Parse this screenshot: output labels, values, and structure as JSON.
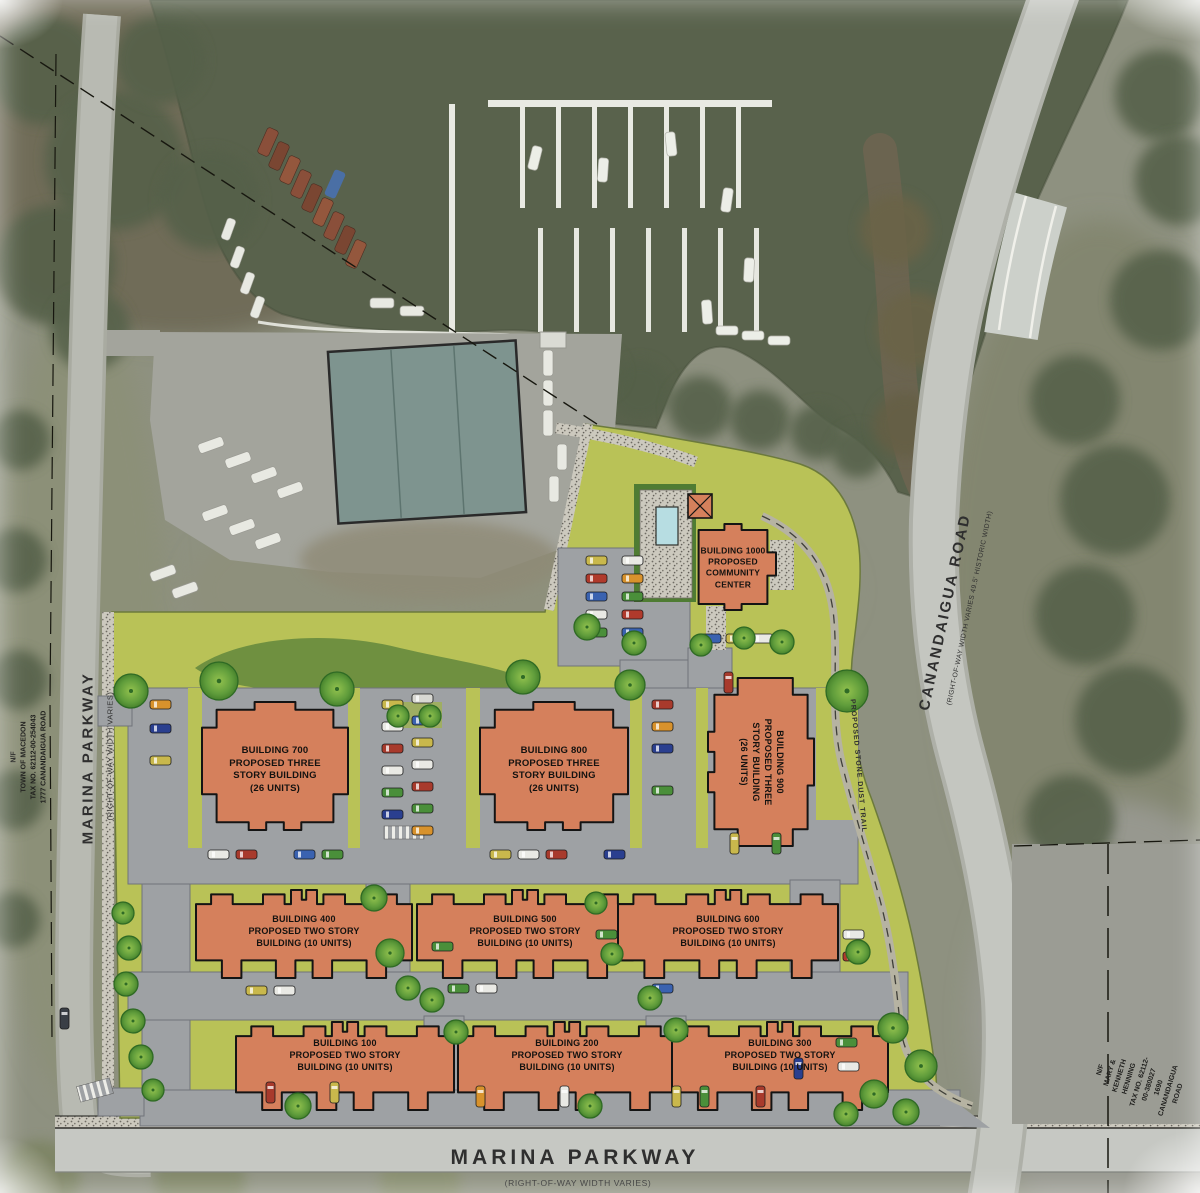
{
  "plan": {
    "roads": {
      "marina_parkway_left": {
        "name": "MARINA PARKWAY",
        "detail": "(RIGHT-OF-WAY WIDTH VARIES)"
      },
      "marina_parkway_bottom": {
        "name": "MARINA PARKWAY",
        "detail": "(RIGHT-OF-WAY WIDTH VARIES)"
      },
      "canandaigua_road": {
        "name": "CANANDAIGUA ROAD",
        "detail": "(RIGHT-OF-WAY WIDTH VARIES 49.5' HISTORIC WIDTH)"
      }
    },
    "parcel_notes": {
      "west": "N/F\nTOWN OF MACEDON\nTAX NO. 62112-00-254043\n1777 CANANDAIGUA ROAD",
      "east": "N/F\nMARY & KENNETH HENNING\nTAX NO. 62112-00-380027\n1690 CANANDAIGUA ROAD"
    },
    "trail_label": "PROPOSED STONE DUST TRAIL",
    "buildings": [
      {
        "id": "700",
        "label": "BUILDING 700\nPROPOSED THREE\nSTORY BUILDING\n(26 UNITS)",
        "shape": "h3",
        "x": 202,
        "y": 702,
        "w": 146,
        "h": 128,
        "lx": 275,
        "ly": 770,
        "fs": 9.5
      },
      {
        "id": "800",
        "label": "BUILDING 800\nPROPOSED THREE\nSTORY BUILDING\n(26 UNITS)",
        "shape": "h3",
        "x": 480,
        "y": 702,
        "w": 148,
        "h": 128,
        "lx": 554,
        "ly": 770,
        "fs": 9.5
      },
      {
        "id": "900",
        "label": "BUILDING 900\nPROPOSED THREE\nSTORY BUILDING\n(26 UNITS)",
        "shape": "h3",
        "rot": 90,
        "x": 708,
        "y": 678,
        "w": 106,
        "h": 168,
        "lx": 761,
        "ly": 762,
        "fs": 9
      },
      {
        "id": "400",
        "label": "BUILDING 400\nPROPOSED TWO STORY\nBUILDING (10 UNITS)",
        "shape": "bar",
        "x": 196,
        "y": 890,
        "w": 216,
        "h": 88,
        "lx": 304,
        "ly": 932,
        "fs": 9
      },
      {
        "id": "500",
        "label": "BUILDING 500\nPROPOSED TWO STORY\nBUILDING (10 UNITS)",
        "shape": "bar",
        "x": 417,
        "y": 890,
        "w": 216,
        "h": 88,
        "lx": 525,
        "ly": 932,
        "fs": 9
      },
      {
        "id": "600",
        "label": "BUILDING 600\nPROPOSED TWO STORY\nBUILDING (10 UNITS)",
        "shape": "bar",
        "x": 618,
        "y": 890,
        "w": 220,
        "h": 88,
        "lx": 728,
        "ly": 932,
        "fs": 9
      },
      {
        "id": "100",
        "label": "BUILDING 100\nPROPOSED TWO STORY\nBUILDING (10 UNITS)",
        "shape": "bar",
        "x": 236,
        "y": 1022,
        "w": 218,
        "h": 88,
        "lx": 345,
        "ly": 1056,
        "fs": 9
      },
      {
        "id": "200",
        "label": "BUILDING 200\nPROPOSED TWO STORY\nBUILDING (10 UNITS)",
        "shape": "bar",
        "x": 458,
        "y": 1022,
        "w": 218,
        "h": 88,
        "lx": 567,
        "ly": 1056,
        "fs": 9
      },
      {
        "id": "300",
        "label": "BUILDING 300\nPROPOSED TWO STORY\nBUILDING (10 UNITS)",
        "shape": "bar",
        "x": 672,
        "y": 1022,
        "w": 216,
        "h": 88,
        "lx": 780,
        "ly": 1056,
        "fs": 9
      },
      {
        "id": "1000",
        "label": "BUILDING 1000\nPROPOSED\nCOMMUNITY\nCENTER",
        "shape": "cc",
        "x": 690,
        "y": 524,
        "w": 86,
        "h": 86,
        "lx": 733,
        "ly": 568,
        "fs": 8.5
      }
    ],
    "colors": {
      "site_green": "#b9c257",
      "building": "#d5805c",
      "building_outline": "#141414",
      "pavement": "#9ea1a4",
      "water": "#59624c",
      "road": "#c4c6c0",
      "pool": "#b7dde2"
    }
  },
  "decor": {
    "trees": [
      [
        131,
        691,
        17
      ],
      [
        219,
        681,
        19
      ],
      [
        337,
        689,
        17
      ],
      [
        523,
        677,
        17
      ],
      [
        630,
        685,
        15
      ],
      [
        847,
        691,
        21
      ],
      [
        587,
        627,
        13
      ],
      [
        634,
        643,
        12
      ],
      [
        701,
        645,
        11
      ],
      [
        744,
        638,
        11
      ],
      [
        782,
        642,
        12
      ],
      [
        398,
        716,
        11
      ],
      [
        430,
        716,
        11
      ],
      [
        374,
        898,
        13
      ],
      [
        390,
        953,
        14
      ],
      [
        408,
        988,
        12
      ],
      [
        596,
        903,
        11
      ],
      [
        612,
        954,
        11
      ],
      [
        123,
        913,
        11
      ],
      [
        129,
        948,
        12
      ],
      [
        126,
        984,
        12
      ],
      [
        133,
        1021,
        12
      ],
      [
        141,
        1057,
        12
      ],
      [
        153,
        1090,
        11
      ],
      [
        432,
        1000,
        12
      ],
      [
        456,
        1032,
        12
      ],
      [
        650,
        998,
        12
      ],
      [
        676,
        1030,
        12
      ],
      [
        893,
        1028,
        15
      ],
      [
        921,
        1066,
        16
      ],
      [
        874,
        1094,
        14
      ],
      [
        846,
        1114,
        12
      ],
      [
        906,
        1112,
        13
      ],
      [
        858,
        952,
        12
      ],
      [
        298,
        1106,
        13
      ],
      [
        590,
        1106,
        12
      ]
    ],
    "brush": [
      [
        45,
        70,
        55
      ],
      [
        115,
        160,
        70
      ],
      [
        55,
        265,
        60
      ],
      [
        160,
        60,
        45
      ],
      [
        210,
        200,
        50
      ],
      [
        90,
        330,
        40
      ],
      [
        640,
        390,
        30
      ],
      [
        700,
        408,
        32
      ],
      [
        760,
        420,
        30
      ],
      [
        818,
        432,
        28
      ],
      [
        858,
        452,
        26
      ],
      [
        600,
        372,
        24
      ],
      [
        895,
        230,
        35,
        "#6b6347"
      ],
      [
        915,
        330,
        38,
        "#6b6347"
      ],
      [
        905,
        425,
        32,
        "#655f45"
      ],
      [
        1160,
        95,
        45
      ],
      [
        1180,
        180,
        45
      ],
      [
        1160,
        300,
        50
      ],
      [
        1075,
        400,
        45
      ],
      [
        1115,
        500,
        55
      ],
      [
        1085,
        615,
        50
      ],
      [
        1130,
        720,
        55
      ],
      [
        1070,
        820,
        45
      ],
      [
        1110,
        890,
        40
      ],
      [
        20,
        440,
        30
      ],
      [
        15,
        560,
        32
      ],
      [
        18,
        680,
        30
      ],
      [
        14,
        800,
        30
      ],
      [
        12,
        920,
        28
      ],
      [
        40,
        1180,
        40,
        "#7d8464"
      ],
      [
        200,
        1182,
        45,
        "#7d8464"
      ],
      [
        420,
        1184,
        40,
        "#868c6c"
      ]
    ],
    "cars": [
      [
        586,
        556,
        "h",
        "#c9b84c"
      ],
      [
        586,
        574,
        "h",
        "#b03a2c"
      ],
      [
        586,
        592,
        "h",
        "#3a62b0"
      ],
      [
        586,
        610,
        "h",
        "#e9e9e4"
      ],
      [
        586,
        628,
        "h",
        "#4a8f3a"
      ],
      [
        622,
        556,
        "h",
        "#e9e9e4"
      ],
      [
        622,
        574,
        "h",
        "#d8922c"
      ],
      [
        622,
        592,
        "h",
        "#4a8f3a"
      ],
      [
        622,
        610,
        "h",
        "#b03a2c"
      ],
      [
        622,
        628,
        "h",
        "#3a62b0"
      ],
      [
        700,
        634,
        "h",
        "#3a62b0"
      ],
      [
        726,
        634,
        "h",
        "#c9b84c"
      ],
      [
        752,
        634,
        "h",
        "#e9e9e4"
      ],
      [
        382,
        700,
        "h",
        "#c9b84c"
      ],
      [
        382,
        722,
        "h",
        "#e9e9e4"
      ],
      [
        382,
        744,
        "h",
        "#a83a2c"
      ],
      [
        382,
        766,
        "h",
        "#e9e9e4"
      ],
      [
        382,
        788,
        "h",
        "#4a8f3a"
      ],
      [
        382,
        810,
        "h",
        "#2a3f8f"
      ],
      [
        412,
        694,
        "h",
        "#d8d8d2"
      ],
      [
        412,
        716,
        "h",
        "#3a62b0"
      ],
      [
        412,
        738,
        "h",
        "#c9b84c"
      ],
      [
        412,
        760,
        "h",
        "#e9e9e4"
      ],
      [
        412,
        782,
        "h",
        "#a83a2c"
      ],
      [
        412,
        804,
        "h",
        "#4a8f3a"
      ],
      [
        412,
        826,
        "h",
        "#d8922c"
      ],
      [
        150,
        700,
        "h",
        "#d8922c"
      ],
      [
        150,
        724,
        "h",
        "#2a3f8f"
      ],
      [
        150,
        756,
        "h",
        "#c9b84c"
      ],
      [
        652,
        700,
        "h",
        "#a83a2c"
      ],
      [
        652,
        722,
        "h",
        "#d8922c"
      ],
      [
        652,
        744,
        "h",
        "#2a3f8f"
      ],
      [
        652,
        786,
        "h",
        "#4a8f3a"
      ],
      [
        724,
        672,
        "v",
        "#a83a2c"
      ],
      [
        730,
        833,
        "v",
        "#c9b84c"
      ],
      [
        772,
        833,
        "v",
        "#4a8f3a"
      ],
      [
        208,
        850,
        "h",
        "#e9e9e4"
      ],
      [
        236,
        850,
        "h",
        "#a83a2c"
      ],
      [
        294,
        850,
        "h",
        "#3a62b0"
      ],
      [
        322,
        850,
        "h",
        "#4a8f3a"
      ],
      [
        490,
        850,
        "h",
        "#c9b84c"
      ],
      [
        518,
        850,
        "h",
        "#e9e9e4"
      ],
      [
        546,
        850,
        "h",
        "#a83a2c"
      ],
      [
        604,
        850,
        "h",
        "#2a3f8f"
      ],
      [
        432,
        942,
        "h",
        "#4a8f3a"
      ],
      [
        596,
        930,
        "h",
        "#4a8f3a"
      ],
      [
        843,
        930,
        "h",
        "#e9e9e4"
      ],
      [
        843,
        952,
        "h",
        "#b03a2c"
      ],
      [
        246,
        986,
        "h",
        "#c9b84c"
      ],
      [
        274,
        986,
        "h",
        "#e9e9e4"
      ],
      [
        448,
        984,
        "h",
        "#4a8f3a"
      ],
      [
        476,
        984,
        "h",
        "#e9e9e4"
      ],
      [
        652,
        984,
        "h",
        "#3a62b0"
      ],
      [
        266,
        1082,
        "v",
        "#a83a2c"
      ],
      [
        330,
        1082,
        "v",
        "#c9b84c"
      ],
      [
        476,
        1086,
        "v",
        "#d8922c"
      ],
      [
        560,
        1086,
        "v",
        "#e9e9e4"
      ],
      [
        672,
        1086,
        "v",
        "#c9b84c"
      ],
      [
        700,
        1086,
        "v",
        "#4a8f3a"
      ],
      [
        756,
        1086,
        "v",
        "#a83a2c"
      ],
      [
        794,
        1058,
        "v",
        "#2a3f8f"
      ],
      [
        836,
        1038,
        "h",
        "#4a8f3a"
      ],
      [
        838,
        1062,
        "h",
        "#e9e9e4"
      ],
      [
        60,
        1008,
        "v",
        "#3a3f46"
      ]
    ]
  }
}
